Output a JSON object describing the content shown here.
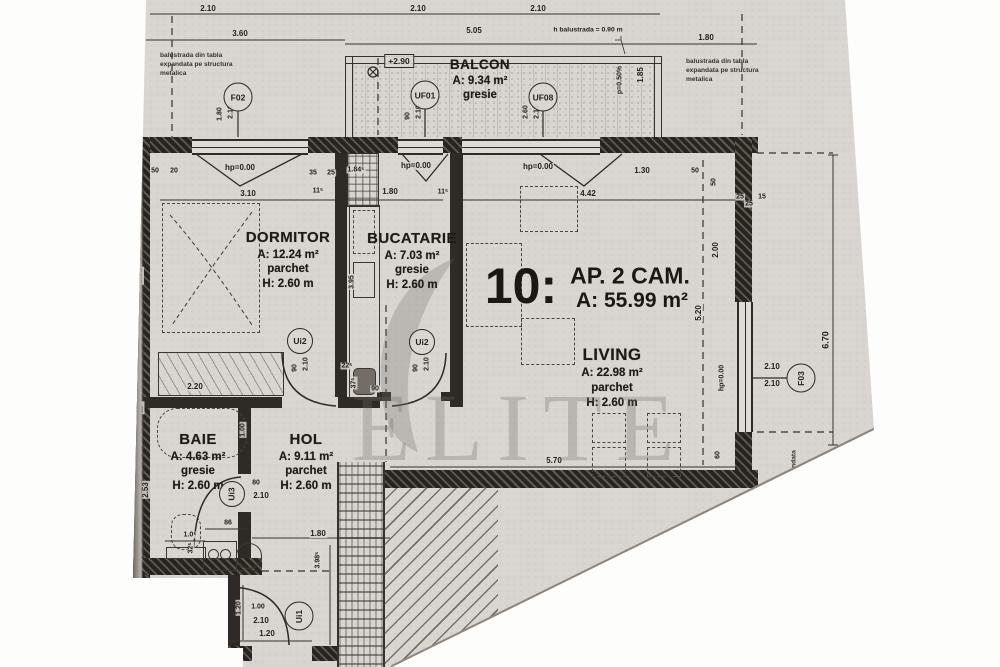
{
  "title": {
    "unit_number": "10:",
    "unit_type": "AP. 2 CAM.",
    "unit_area": "A: 55.99 m²"
  },
  "rooms": {
    "balcon": {
      "name": "BALCON",
      "area": "A: 9.34 m²",
      "floor": "gresie"
    },
    "dormitor": {
      "name": "DORMITOR",
      "area": "A: 12.24 m²",
      "floor": "parchet",
      "height": "H: 2.60 m"
    },
    "bucatarie": {
      "name": "BUCATARIE",
      "area": "A: 7.03 m²",
      "floor": "gresie",
      "height": "H: 2.60 m"
    },
    "living": {
      "name": "LIVING",
      "area": "A: 22.98 m²",
      "floor": "parchet",
      "height": "H: 2.60 m"
    },
    "baie": {
      "name": "BAIE",
      "area": "A: 4.63 m²",
      "floor": "gresie",
      "height": "H: 2.60 m"
    },
    "hol": {
      "name": "HOL",
      "area": "A: 9.11 m²",
      "floor": "parchet",
      "height": "H: 2.60 m"
    }
  },
  "tags": {
    "f02": "F02",
    "uf01": "UF01",
    "uf08": "UF08",
    "f03": "F03",
    "ui2_dormitor": "Ui2",
    "ui2_bucatarie": "Ui2",
    "ui3": "Ui3",
    "ui1": "Ui1"
  },
  "notes": {
    "balustrade_left": "balustrada din tabla expandata pe structura metalica",
    "balustrade_right": "balustrada din tabla expandata pe structura metalica",
    "balustrade_bottom": "balustrada din tabla expandata",
    "level": "+2.90",
    "parapet_height": "h balustrada = 0.90 m",
    "slope": "p=0.50%"
  },
  "watermark": "ELITE",
  "colors": {
    "paper": "#d9d6d1",
    "ink": "#2e2b26",
    "watermark": "rgba(112,105,96,0.30)"
  },
  "dimensions": [
    {
      "t": "2.10",
      "x": 208,
      "y": 9
    },
    {
      "t": "2.10",
      "x": 418,
      "y": 9
    },
    {
      "t": "2.10",
      "x": 538,
      "y": 9
    },
    {
      "t": "3.60",
      "x": 240,
      "y": 34
    },
    {
      "t": "5.05",
      "x": 474,
      "y": 31
    },
    {
      "t": "1.80",
      "x": 706,
      "y": 38
    },
    {
      "t": "1.85",
      "x": 641,
      "y": 75,
      "r": -90
    },
    {
      "t": "1.80",
      "x": 220,
      "y": 114,
      "r": -90,
      "fs": 7
    },
    {
      "t": "2.10",
      "x": 231,
      "y": 112,
      "r": -90,
      "fs": 7
    },
    {
      "t": "90",
      "x": 408,
      "y": 116,
      "r": -90,
      "fs": 7
    },
    {
      "t": "2.10",
      "x": 419,
      "y": 112,
      "r": -90,
      "fs": 7
    },
    {
      "t": "2.60",
      "x": 526,
      "y": 112,
      "r": -90,
      "fs": 7
    },
    {
      "t": "2.10",
      "x": 537,
      "y": 112,
      "r": -90,
      "fs": 7
    },
    {
      "t": "50",
      "x": 155,
      "y": 171,
      "fs": 7
    },
    {
      "t": "20",
      "x": 174,
      "y": 171,
      "fs": 7
    },
    {
      "t": "hp=0.00",
      "x": 240,
      "y": 168
    },
    {
      "t": "35",
      "x": 313,
      "y": 173,
      "fs": 7
    },
    {
      "t": "25",
      "x": 331,
      "y": 173,
      "fs": 7
    },
    {
      "t": "1.84⁵",
      "x": 356,
      "y": 170,
      "fs": 7
    },
    {
      "t": "hp=0.00",
      "x": 416,
      "y": 166
    },
    {
      "t": "hp=0.00",
      "x": 538,
      "y": 167
    },
    {
      "t": "1.30",
      "x": 642,
      "y": 171
    },
    {
      "t": "50",
      "x": 695,
      "y": 171,
      "fs": 7
    },
    {
      "t": "50",
      "x": 714,
      "y": 182,
      "r": -90,
      "fs": 7
    },
    {
      "t": "25",
      "x": 740,
      "y": 197,
      "fs": 7
    },
    {
      "t": "15",
      "x": 762,
      "y": 197,
      "fs": 7
    },
    {
      "t": "3.10",
      "x": 248,
      "y": 194
    },
    {
      "t": "11⁵",
      "x": 318,
      "y": 191,
      "fs": 7
    },
    {
      "t": "1.80",
      "x": 390,
      "y": 192
    },
    {
      "t": "11⁵",
      "x": 443,
      "y": 192,
      "fs": 7
    },
    {
      "t": "4.42",
      "x": 588,
      "y": 194
    },
    {
      "t": "25",
      "x": 749,
      "y": 204,
      "fs": 7
    },
    {
      "t": "3.95",
      "x": 140,
      "y": 276,
      "r": -90
    },
    {
      "t": "2.20",
      "x": 195,
      "y": 387
    },
    {
      "t": "11⁵",
      "x": 141,
      "y": 408,
      "r": -90,
      "fs": 7
    },
    {
      "t": "2.53",
      "x": 146,
      "y": 490,
      "r": -90
    },
    {
      "t": "3.95",
      "x": 352,
      "y": 282,
      "r": -90,
      "fs": 7
    },
    {
      "t": "90",
      "x": 295,
      "y": 368,
      "r": -90,
      "fs": 7
    },
    {
      "t": "2.10",
      "x": 306,
      "y": 364,
      "r": -90,
      "fs": 7
    },
    {
      "t": "90",
      "x": 416,
      "y": 368,
      "r": -90,
      "fs": 7
    },
    {
      "t": "2.10",
      "x": 427,
      "y": 364,
      "r": -90,
      "fs": 7
    },
    {
      "t": "22⁵",
      "x": 347,
      "y": 366,
      "fs": 7
    },
    {
      "t": "37⁵",
      "x": 354,
      "y": 383,
      "r": -90,
      "fs": 7
    },
    {
      "t": "90",
      "x": 375,
      "y": 389,
      "fs": 7
    },
    {
      "t": "hp=0.00",
      "x": 722,
      "y": 378,
      "r": -90,
      "fs": 7
    },
    {
      "t": "2.10",
      "x": 772,
      "y": 367
    },
    {
      "t": "2.10",
      "x": 772,
      "y": 384
    },
    {
      "t": "2.00",
      "x": 716,
      "y": 250,
      "r": -90
    },
    {
      "t": "5.20",
      "x": 699,
      "y": 313,
      "r": -90
    },
    {
      "t": "6.70",
      "x": 826,
      "y": 340,
      "r": -90,
      "fs": 9
    },
    {
      "t": "60",
      "x": 718,
      "y": 455,
      "r": -90,
      "fs": 7
    },
    {
      "t": "5.70",
      "x": 554,
      "y": 461
    },
    {
      "t": "1.00",
      "x": 243,
      "y": 430,
      "r": -90,
      "fs": 7
    },
    {
      "t": "80",
      "x": 256,
      "y": 483,
      "fs": 7
    },
    {
      "t": "2.10",
      "x": 261,
      "y": 496
    },
    {
      "t": "86",
      "x": 228,
      "y": 523,
      "fs": 7
    },
    {
      "t": "1.0⁵",
      "x": 190,
      "y": 535,
      "fs": 7
    },
    {
      "t": "32⁵",
      "x": 191,
      "y": 548,
      "r": -90,
      "fs": 7
    },
    {
      "t": "1.80",
      "x": 318,
      "y": 534
    },
    {
      "t": "3.98⁵",
      "x": 318,
      "y": 560,
      "r": -90,
      "fs": 7
    },
    {
      "t": "1.20",
      "x": 239,
      "y": 608,
      "r": -90,
      "fs": 7
    },
    {
      "t": "1.00",
      "x": 258,
      "y": 607,
      "fs": 7
    },
    {
      "t": "2.10",
      "x": 261,
      "y": 621
    },
    {
      "t": "1.20",
      "x": 267,
      "y": 634
    },
    {
      "t": "25",
      "x": 216,
      "y": 632,
      "fs": 7
    }
  ]
}
